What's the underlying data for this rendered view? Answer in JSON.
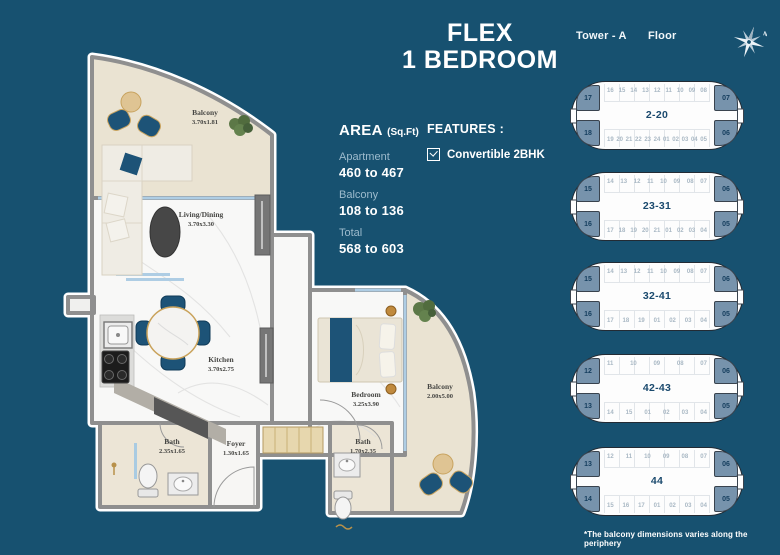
{
  "title": {
    "line1": "FLEX",
    "line2": "1 BEDROOM"
  },
  "area": {
    "heading": "AREA",
    "unit": "(Sq.Ft)",
    "rows": [
      {
        "label": "Apartment",
        "value": "460 to 467"
      },
      {
        "label": "Balcony",
        "value": "108 to 136"
      },
      {
        "label": "Total",
        "value": "568 to 603"
      }
    ]
  },
  "features": {
    "heading": "FEATURES :",
    "items": [
      {
        "checked": true,
        "label": "Convertible 2BHK"
      }
    ]
  },
  "floorplan": {
    "rooms": {
      "balcony_top": {
        "name": "Balcony",
        "dim": "3.70x1.81"
      },
      "living": {
        "name": "Living/Dining",
        "dim": "3.70x3.30"
      },
      "kitchen": {
        "name": "Kitchen",
        "dim": "3.70x2.75"
      },
      "bath_left": {
        "name": "Bath",
        "dim": "2.35x1.65"
      },
      "foyer": {
        "name": "Foyer",
        "dim": "1.30x1.65"
      },
      "bedroom": {
        "name": "Bedroom",
        "dim": "3.25x3.90"
      },
      "balcony_right": {
        "name": "Balcony",
        "dim": "2.00x5.00"
      },
      "bath_right": {
        "name": "Bath",
        "dim": "1.70x2.35"
      }
    }
  },
  "keyplan_panel": {
    "tower_label": "Tower - A",
    "floor_label": "Floor",
    "plans": [
      {
        "floors": "2-20",
        "corners": {
          "tl": "17",
          "bl": "18",
          "tr": "07",
          "br": "06"
        },
        "top_row": [
          "16",
          "15",
          "14",
          "13",
          "12",
          "11",
          "10",
          "09",
          "08"
        ],
        "bottom_row": [
          "19",
          "20",
          "21",
          "22",
          "23",
          "24",
          "01",
          "02",
          "03",
          "04",
          "05"
        ]
      },
      {
        "floors": "23-31",
        "corners": {
          "tl": "15",
          "bl": "16",
          "tr": "06",
          "br": "05"
        },
        "top_row": [
          "14",
          "13",
          "12",
          "11",
          "10",
          "09",
          "08",
          "07"
        ],
        "bottom_row": [
          "17",
          "18",
          "19",
          "20",
          "21",
          "01",
          "02",
          "03",
          "04"
        ]
      },
      {
        "floors": "32-41",
        "corners": {
          "tl": "15",
          "bl": "16",
          "tr": "06",
          "br": "05"
        },
        "top_row": [
          "14",
          "13",
          "12",
          "11",
          "10",
          "09",
          "08",
          "07"
        ],
        "bottom_row": [
          "17",
          "18",
          "19",
          "01",
          "02",
          "03",
          "04"
        ]
      },
      {
        "floors": "42-43",
        "corners": {
          "tl": "12",
          "bl": "13",
          "tr": "06",
          "br": "05"
        },
        "top_row": [
          "11",
          "10",
          "09",
          "08",
          "07"
        ],
        "bottom_row": [
          "14",
          "15",
          "01",
          "02",
          "03",
          "04"
        ]
      },
      {
        "floors": "44",
        "corners": {
          "tl": "13",
          "bl": "14",
          "tr": "06",
          "br": "05"
        },
        "top_row": [
          "12",
          "11",
          "10",
          "09",
          "08",
          "07"
        ],
        "bottom_row": [
          "15",
          "16",
          "17",
          "01",
          "02",
          "03",
          "04"
        ]
      }
    ],
    "footnote": "*The balcony dimensions varies along the periphery"
  },
  "colors": {
    "background": "#175170",
    "accent_blue": "#1d5377",
    "keyplan_highlight": "#7793ac",
    "muted_label": "#9dbbcd",
    "balcony_floor": "#eae3d2",
    "wall_gray": "#8f8f8f"
  }
}
